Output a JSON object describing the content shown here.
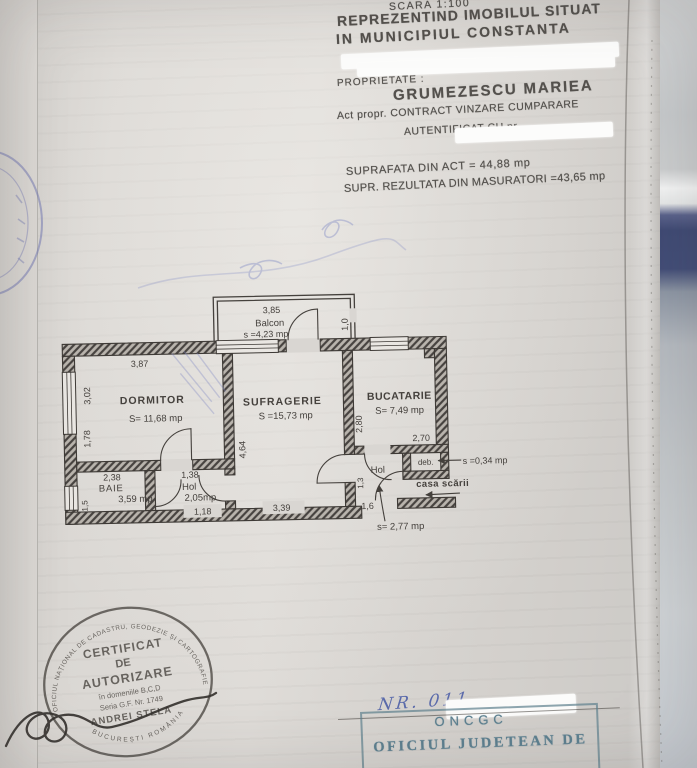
{
  "document": {
    "scale": "SCARA 1:100",
    "title_line1": "REPREZENTIND IMOBILUL SITUAT",
    "title_line2": "IN MUNICIPIUL CONSTANTA",
    "owner_label": "PROPRIETATE :",
    "owner_name": "GRUMEZESCU MARIEA",
    "deed_line1": "Act propr. CONTRACT VINZARE CUMPARARE",
    "deed_line2": "AUTENTIFICAT CU nr.",
    "area_from_deed": "SUPRAFATA DIN ACT = 44,88 mp",
    "area_measured": "SUPR. REZULTATA DIN MASURATORI =43,65 mp"
  },
  "floorplan": {
    "balcony": {
      "name": "Balcon",
      "area": "s =4,23 mp",
      "dim_top": "3,85",
      "dim_right": "1,0"
    },
    "bedroom": {
      "name": "DORMITOR",
      "area": "S= 11,68 mp",
      "dim_top": "3,87",
      "dim_left_upper": "3,02",
      "dim_left_lower": "1,78"
    },
    "living": {
      "name": "SUFRAGERIE",
      "area": "S =15,73 mp",
      "dim_left": "4,64",
      "dim_bottom": "3,39"
    },
    "kitchen": {
      "name": "BUCATARIE",
      "area": "S= 7,49 mp",
      "dim_left": "2,80",
      "dim_bottom": "2,70"
    },
    "bathroom": {
      "name": "BAIE",
      "area": "3,59 mp",
      "dim_top": "2,38",
      "dim_left": "1,5"
    },
    "hall1": {
      "name": "Hol",
      "area": "2,05mp",
      "dim_top": "1,38",
      "dim_bottom": "1,18"
    },
    "hall2": {
      "name": "Hol",
      "area": "s= 2,77 mp",
      "dim_left": "1,3",
      "dim_bottom": "1,6"
    },
    "pantry": {
      "name": "deb.",
      "area": "s =0,34 mp"
    },
    "stairwell_label": "casa scării"
  },
  "round_stamp": {
    "ring_top": "OFICIUL NAȚIONAL DE CADASTRU, GEODEZIE ȘI CARTOGRAFIE",
    "ring_bottom": "BUCUREȘTI  ROMÂNIA",
    "line1": "CERTIFICAT",
    "line2": "DE",
    "line3": "AUTORIZARE",
    "line4": "în domeniile B,C,D",
    "line5": "Seria G.F. Nr. 1749",
    "line6": "ANDREI STELA"
  },
  "footer": {
    "handwritten_nr": "NR. 011",
    "handwritten_suffix": "980/s",
    "office_abbr": "ONCGC",
    "office_name": "OFICIUL JUDETEAN DE"
  }
}
